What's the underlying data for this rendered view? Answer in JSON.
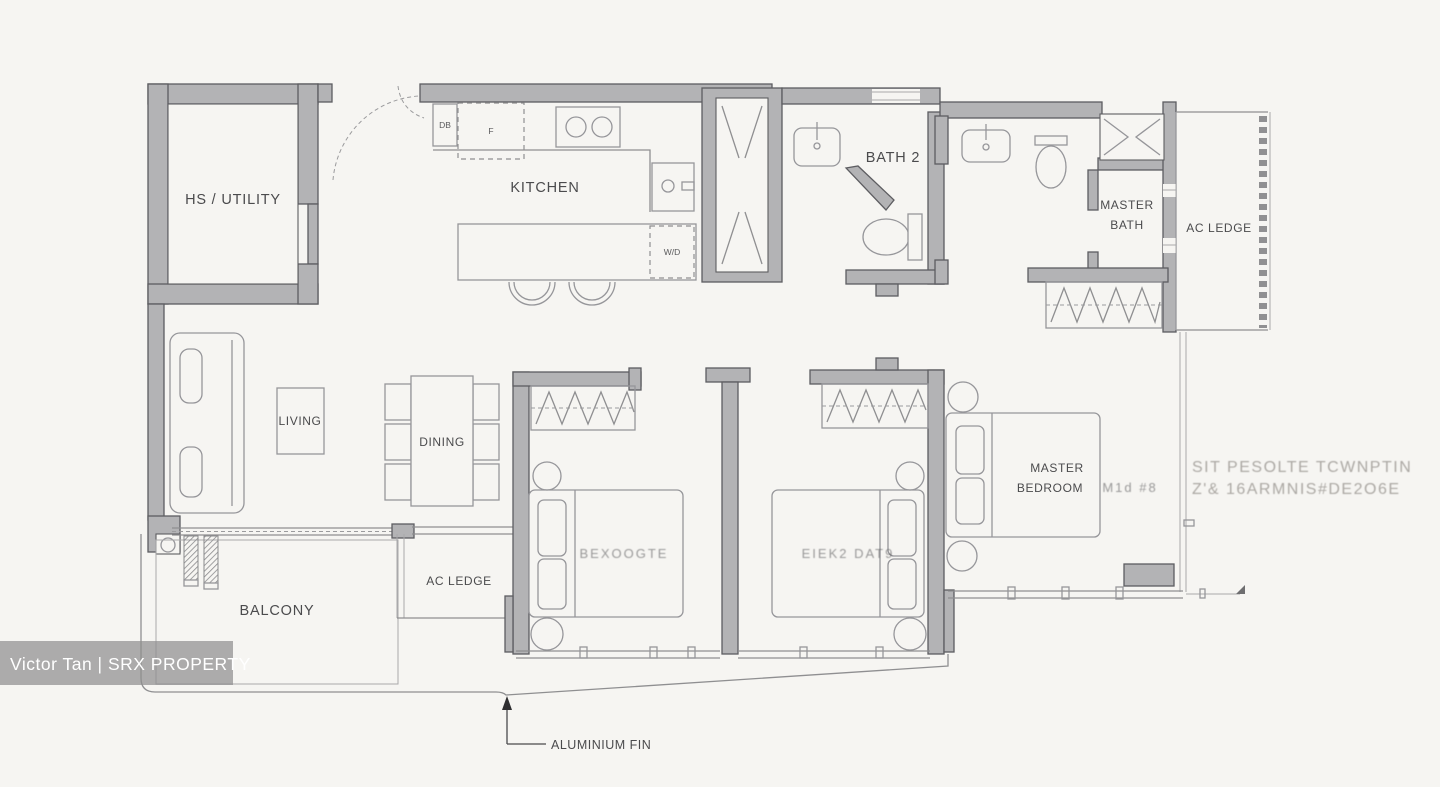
{
  "colors": {
    "background": "#f6f5f2",
    "wall_fill": "#b3b3b5",
    "wall_stroke": "#5d5d61",
    "line": "#8f8f91",
    "label_text": "#4b4b4d",
    "watermark_bar": "#8f8f8f",
    "watermark_text": "#ffffff"
  },
  "rooms": {
    "hs_utility": "HS / UTILITY",
    "kitchen": "KITCHEN",
    "bath2": "BATH 2",
    "master_bath_l1": "MASTER",
    "master_bath_l2": "BATH",
    "ac_ledge_right": "AC LEDGE",
    "living": "LIVING",
    "dining": "DINING",
    "bedroom3_garbled": "BEXOOGTE",
    "bedroom2_garbled": "EIEK2 DAT9",
    "master_bedroom_l1": "MASTER",
    "master_bedroom_l2": "BEDROOM",
    "master_bedroom_garble": "M1d  #8",
    "ac_ledge_bottom": "AC LEDGE",
    "balcony": "BALCONY"
  },
  "fixtures": {
    "distribution_board": "DB",
    "fridge": "F",
    "washer_dryer": "W/D"
  },
  "annotations": {
    "aluminium_fin": "ALUMINIUM FIN"
  },
  "watermark": {
    "agent": "Victor Tan | SRX PROPERTY",
    "garbled_line1": "SIT PESOLTE TCWNPTIN",
    "garbled_line2": "Z'& 16ARMNIS#DE2O6E"
  }
}
